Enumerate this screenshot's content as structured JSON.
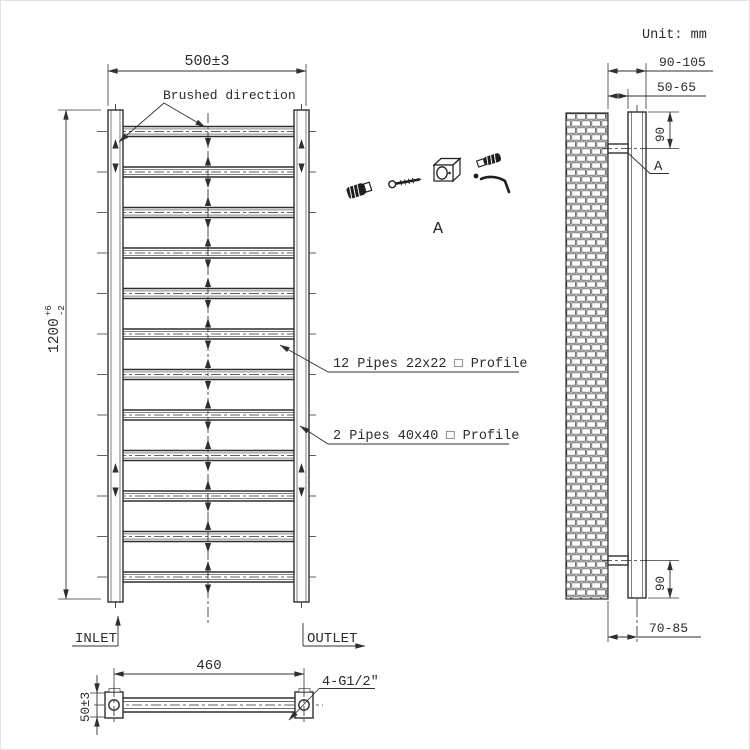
{
  "unit_label": "Unit: mm",
  "colors": {
    "line": "#2f2f2f",
    "background": "#ffffff"
  },
  "front_view": {
    "width_dim": "500±3",
    "height_dim": {
      "value": "1200",
      "tol_plus": "+6",
      "tol_minus": "-2"
    },
    "brushed_label": "Brushed direction",
    "pipes_small_label": "12 Pipes 22x22 □ Profile",
    "pipes_large_label": "2 Pipes 40x40 □ Profile",
    "inlet_label": "INLET",
    "outlet_label": "OUTLET",
    "pipe_count": 12
  },
  "bottom_view": {
    "length_dim": "460",
    "height_dim": "50±3",
    "thread_label": "4-G1/2″"
  },
  "side_view": {
    "depth_total_dim": "90-105",
    "wall_gap_dim": "50-65",
    "bracket_top_dim": "90",
    "bracket_bottom_dim": "90",
    "center_depth_dim": "70-85",
    "detail_ref": "A"
  },
  "detail": {
    "label": "A"
  }
}
